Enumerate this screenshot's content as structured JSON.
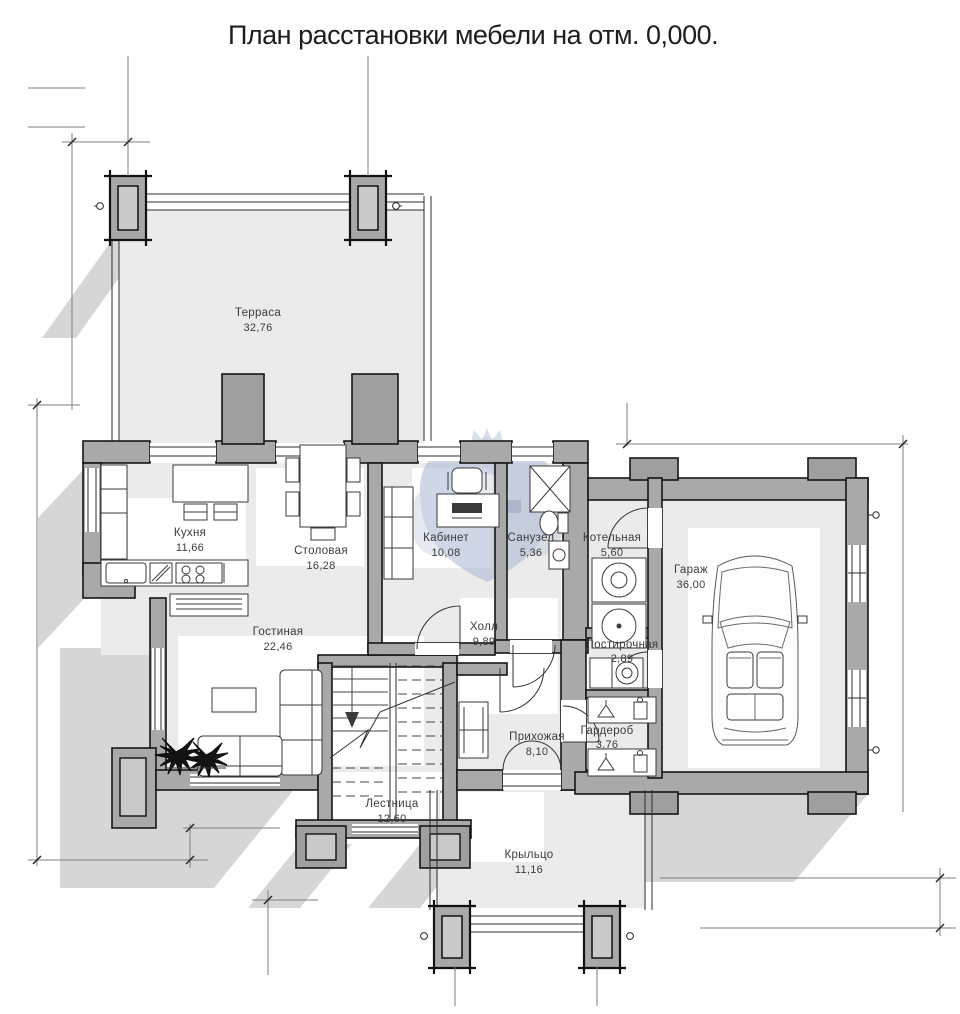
{
  "title": "План расстановки мебели на отм. 0,000.",
  "plan": {
    "drawing_type": "floor-plan",
    "elevation": "0,000",
    "rooms": [
      {
        "name": "Терраса",
        "area": "32,76"
      },
      {
        "name": "Кухня",
        "area": "11,66"
      },
      {
        "name": "Столовая",
        "area": "16,28"
      },
      {
        "name": "Кабинет",
        "area": "10,08"
      },
      {
        "name": "Санузел",
        "area": "5,36"
      },
      {
        "name": "Котельная",
        "area": "5,60"
      },
      {
        "name": "Гараж",
        "area": "36,00"
      },
      {
        "name": "Гостиная",
        "area": "22,46"
      },
      {
        "name": "Холл",
        "area": "9,89"
      },
      {
        "name": "Постирочная",
        "area": "2,89"
      },
      {
        "name": "Прихожая",
        "area": "8,10"
      },
      {
        "name": "Гардероб",
        "area": "3,76"
      },
      {
        "name": "Лестница",
        "area": "12,60"
      },
      {
        "name": "Крыльцо",
        "area": "11,16"
      }
    ],
    "colors": {
      "wall": "#a9a9a9",
      "shadow": "#d6d6d6",
      "watermark": "#a9b6d3",
      "line": "#161616"
    }
  }
}
